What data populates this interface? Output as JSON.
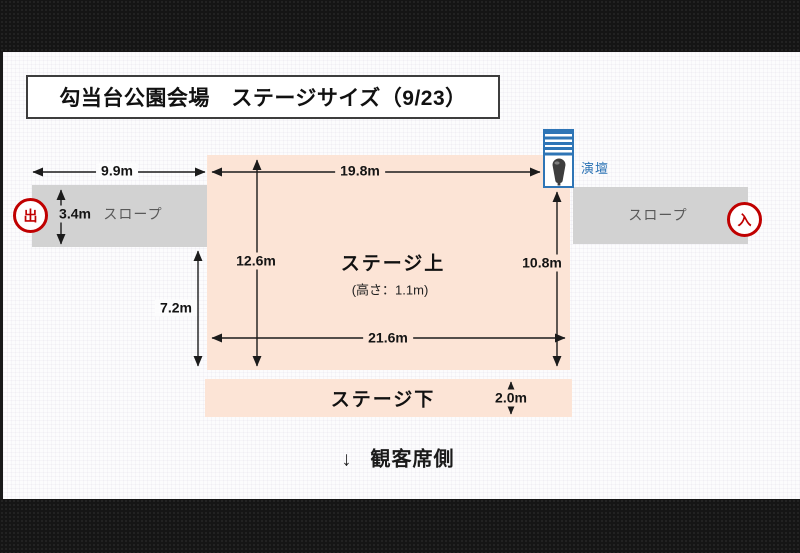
{
  "title": "勾当台公園会場　ステージサイズ（9/23）",
  "diagram": {
    "stage_upper": {
      "label": "ステージ上",
      "height_note": "(高さ：1.1m)",
      "dim_top_width": "19.8m",
      "dim_bottom_width": "21.6m",
      "dim_left_height": "12.6m",
      "dim_right_height": "10.8m"
    },
    "stage_lower": {
      "label": "ステージ下",
      "dim_depth": "2.0m"
    },
    "slope_left": {
      "label": "スロープ",
      "dim_width": "9.9m",
      "dim_height": "3.4m"
    },
    "slope_right": {
      "label": "スロープ"
    },
    "dim_offstage_height": "7.2m",
    "exit_badge": "出",
    "entry_badge": "入",
    "podium_label": "演壇",
    "audience_arrow": "↓",
    "audience_label": "観客席側"
  },
  "colors": {
    "stage_fill": "#fce4d6",
    "slope_fill": "#d2d2d2",
    "badge_red": "#c00000",
    "podium_blue": "#2e75b6"
  }
}
